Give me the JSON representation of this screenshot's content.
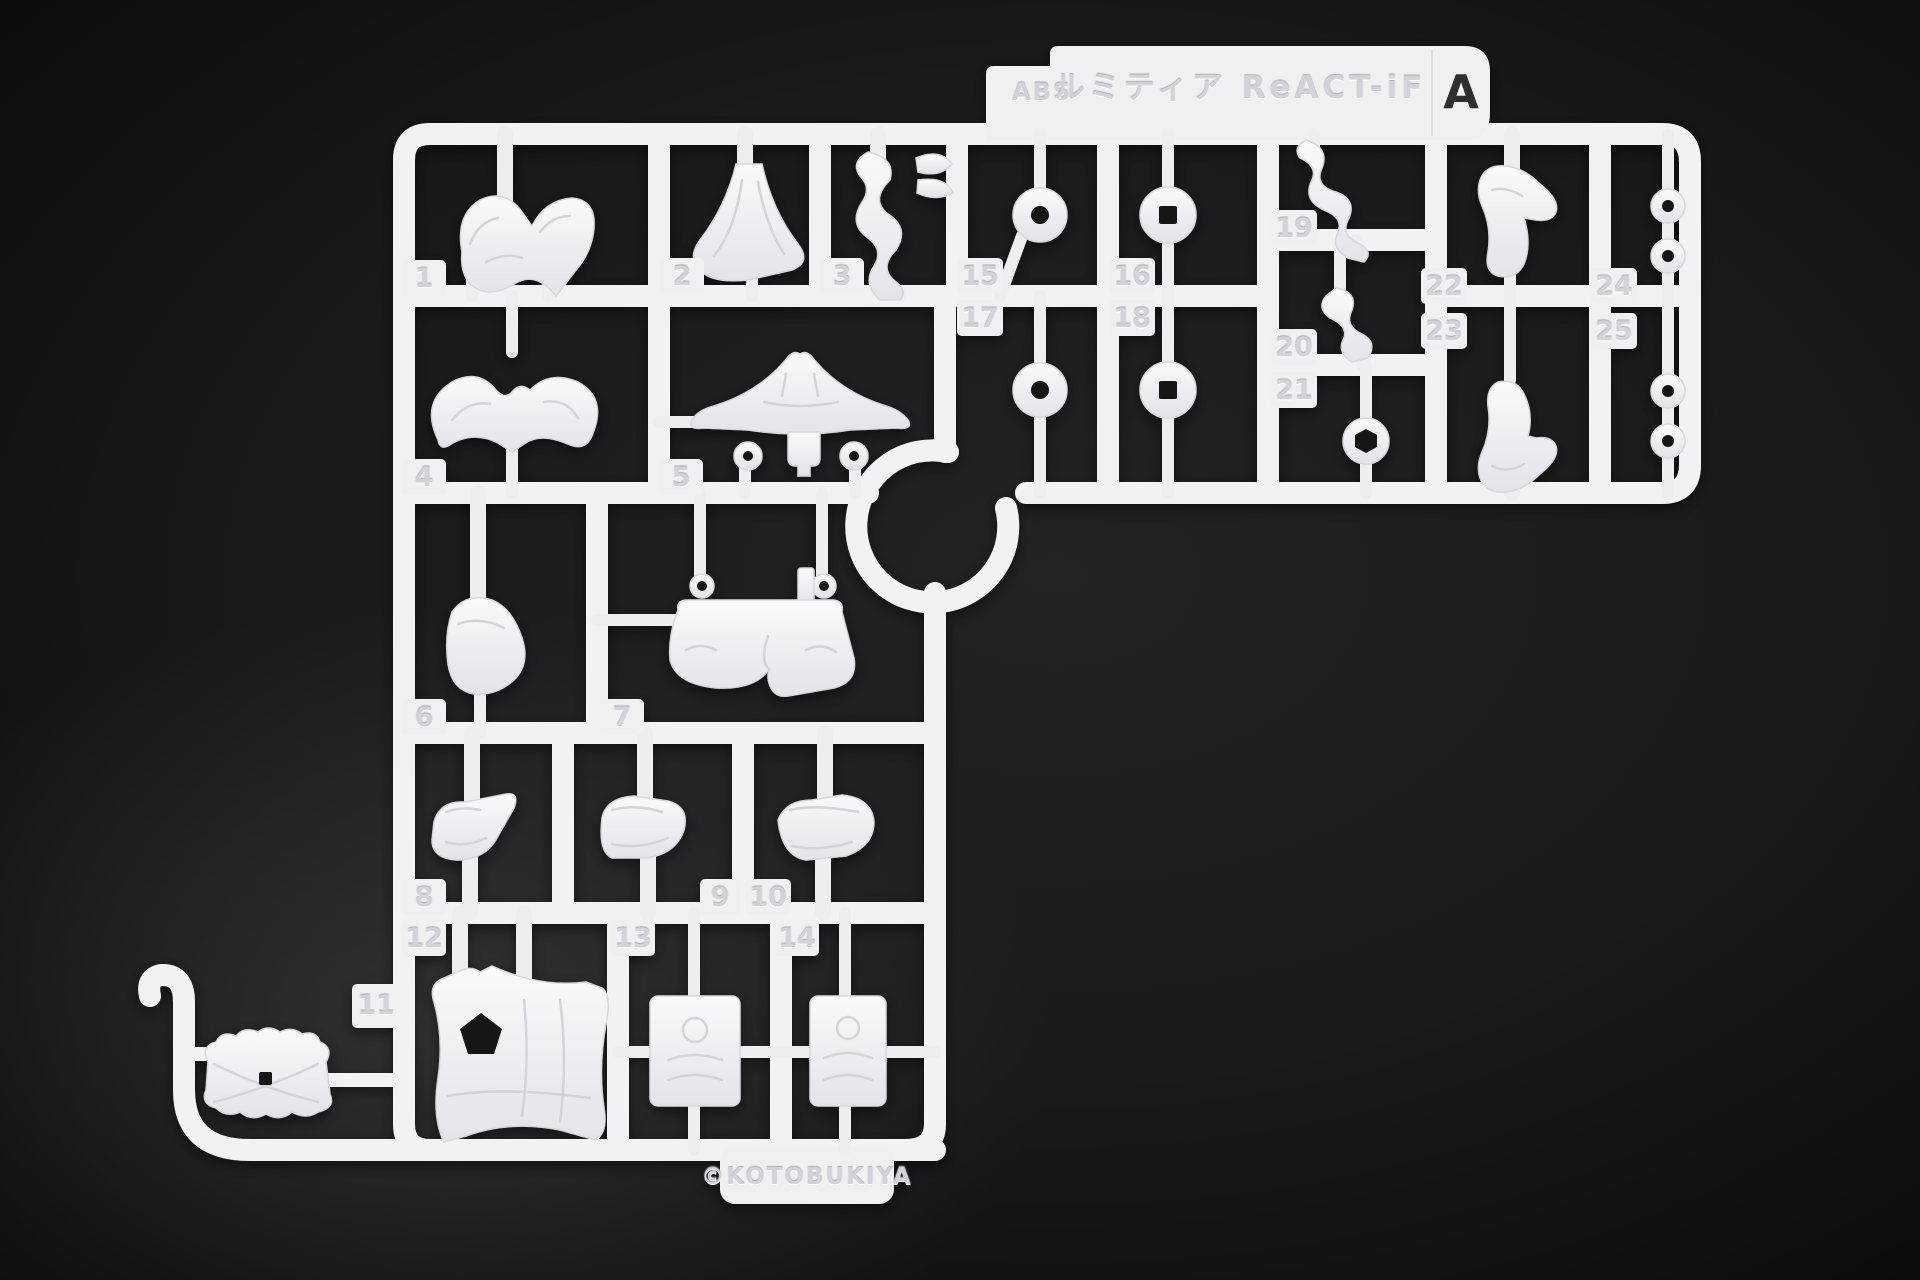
{
  "runner": {
    "material_marking": "ABS",
    "title_marking": "ルミティア ReACT-iF",
    "runner_letter": "A",
    "copyright_marking": "©KOTOBUKIYA",
    "plastic_color": "#f2f2f4",
    "background_color": "#19191b",
    "part_numbers": [
      "1",
      "2",
      "3",
      "4",
      "5",
      "6",
      "7",
      "8",
      "9",
      "10",
      "11",
      "12",
      "13",
      "14",
      "15",
      "16",
      "17",
      "18",
      "19",
      "20",
      "21",
      "22",
      "23",
      "24",
      "25"
    ]
  }
}
